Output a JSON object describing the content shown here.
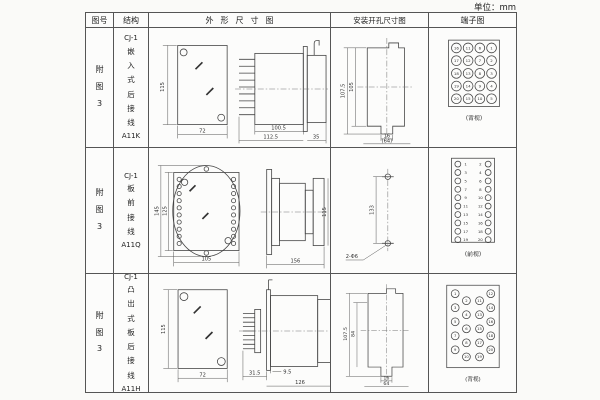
{
  "unit_label": "单位：mm",
  "header": {
    "figure_no": "图号",
    "structure": "结构",
    "outline": "外形尺寸图",
    "mounting": "安装开孔尺寸图",
    "terminal": "端子图"
  },
  "rows": [
    {
      "figure_no": "附图3",
      "structure": {
        "series": "CJ-1",
        "mounting_text": "嵌入式后接线",
        "model": "A11K"
      },
      "outline": {
        "front_h": "115",
        "front_w": "72",
        "body_len": "100.5",
        "total_len": "112.5",
        "rear_len": "35"
      },
      "mounting": {
        "outer_h": "107.5",
        "inner_h": "105",
        "slot_w": "16",
        "span_w": "(64)"
      },
      "terminal": {
        "view_label": "(背视)",
        "grid": [
          [
            16,
            11,
            6,
            1
          ],
          [
            17,
            12,
            7,
            2
          ],
          [
            18,
            13,
            8,
            3
          ],
          [
            19,
            14,
            9,
            4
          ],
          [
            20,
            15,
            10,
            5
          ]
        ]
      }
    },
    {
      "figure_no": "附图3",
      "structure": {
        "series": "CJ-1",
        "mounting_text": "板前接线",
        "model": "A11Q"
      },
      "outline": {
        "front_h_outer": "145",
        "front_h_inner": "125",
        "front_w": "105",
        "side_len": "156",
        "side_h": "115"
      },
      "mounting": {
        "hole_pitch": "133",
        "hole_note": "2-Φ6"
      },
      "terminal": {
        "view_label": "(前视)",
        "left_numbers": [
          1,
          3,
          5,
          7,
          9,
          11,
          13,
          15,
          17,
          19
        ],
        "right_numbers": [
          2,
          4,
          6,
          8,
          10,
          12,
          14,
          16,
          18,
          20
        ]
      }
    },
    {
      "figure_no": "附图3",
      "structure": {
        "series": "CJ-1",
        "mounting_text": "凸出式板后接线",
        "model": "A11H"
      },
      "outline": {
        "front_h": "115",
        "front_w": "72",
        "pin_len": "31.5",
        "flange_off": "9.5",
        "body_len": "126"
      },
      "mounting": {
        "outer_h": "107.5",
        "inner_h": "84",
        "slot_w": "16",
        "span_w": "64"
      },
      "terminal": {
        "view_label": "(背视)",
        "left_outer": [
          1,
          3,
          5,
          7,
          9
        ],
        "left_inner": [
          2,
          4,
          6,
          8,
          10
        ],
        "right_inner": [
          11,
          13,
          15,
          17,
          19
        ],
        "right_outer": [
          12,
          14,
          16,
          18,
          20
        ]
      }
    }
  ]
}
